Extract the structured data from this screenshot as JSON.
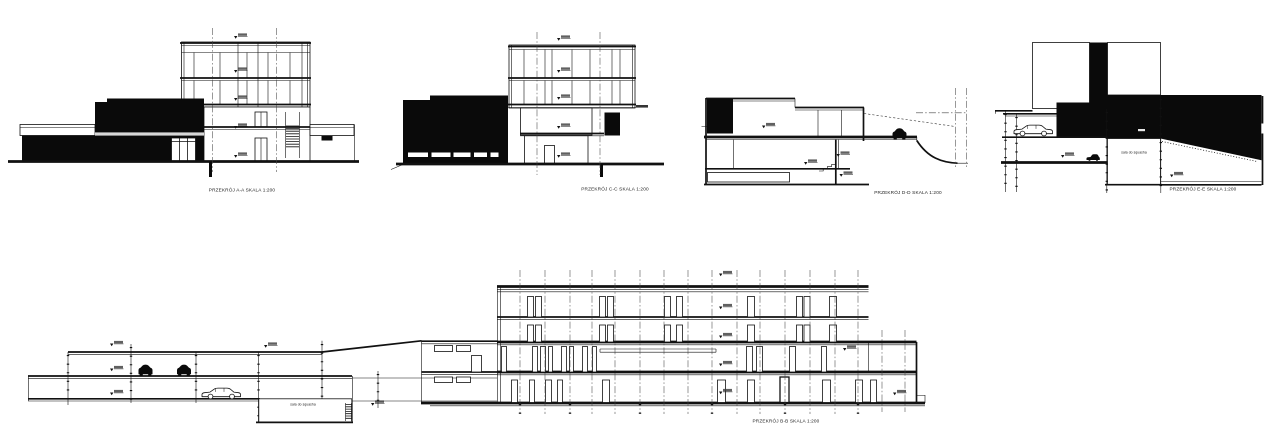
{
  "drawing": {
    "sections": {
      "aa": {
        "caption": "PRZEKRÓJ A-A SKALA 1:200"
      },
      "cc": {
        "caption": "PRZEKRÓJ C-C SKALA 1:200"
      },
      "dd": {
        "caption": "PRZEKRÓJ D-D SKALA 1:200"
      },
      "ee": {
        "caption": "PRZEKRÓJ E-E SKALA 1:200",
        "room_label": "sala do squasha"
      },
      "bb": {
        "caption": "PRZEKRÓJ B-B SKALA 1:200",
        "room_label": "sala do squasha"
      }
    },
    "scale": "1:200",
    "colors": {
      "ink": "#111111",
      "background": "#ffffff"
    }
  }
}
